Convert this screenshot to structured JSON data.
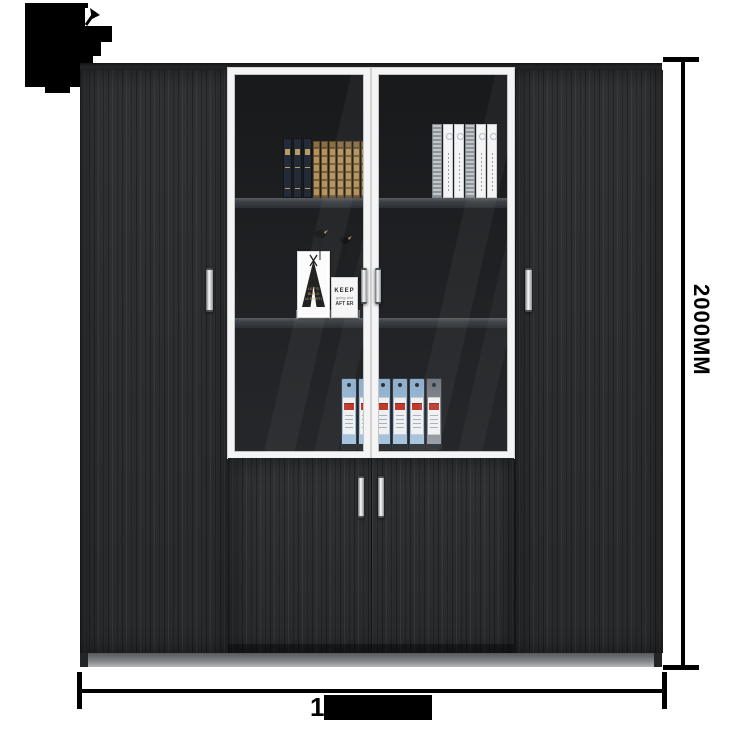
{
  "annotations": {
    "height_dimension": "2000MM",
    "width_dimension_visible_digit": "1",
    "width_dimension_redacted": true
  },
  "art_prints": {
    "teepee_lines": [
      "LET'S",
      "BUILD",
      "•A FORT•"
    ],
    "quote_line_1": "KEEP",
    "quote_line_2": "going and",
    "quote_line_3": "AFT ER"
  },
  "shelf_contents": {
    "navy_books": {
      "count": 3,
      "color": "#242b37",
      "accent": "#b79c63"
    },
    "tan_books": {
      "count": 7,
      "color": "#b3925f",
      "accent": "#6f5633"
    },
    "white_books": {
      "variants": [
        "grey",
        "white",
        "white",
        "grey",
        "white",
        "white"
      ],
      "white_color": "#f3f4f5",
      "grey_color": "#a2a7ad"
    },
    "binders": {
      "variants": [
        "blue",
        "blue",
        "blue",
        "blue",
        "blue",
        "grey"
      ],
      "blue_color": "#a9c6e0",
      "grey_color": "#9aa0a5",
      "label_red": "#c0392b"
    }
  },
  "colors": {
    "wood_dark": "#2b2d2f",
    "frame_white": "#f4f4f4",
    "plinth_grey": "#8f9194",
    "dimension_black": "#000000",
    "glass_interior": "#1a1c1e"
  }
}
